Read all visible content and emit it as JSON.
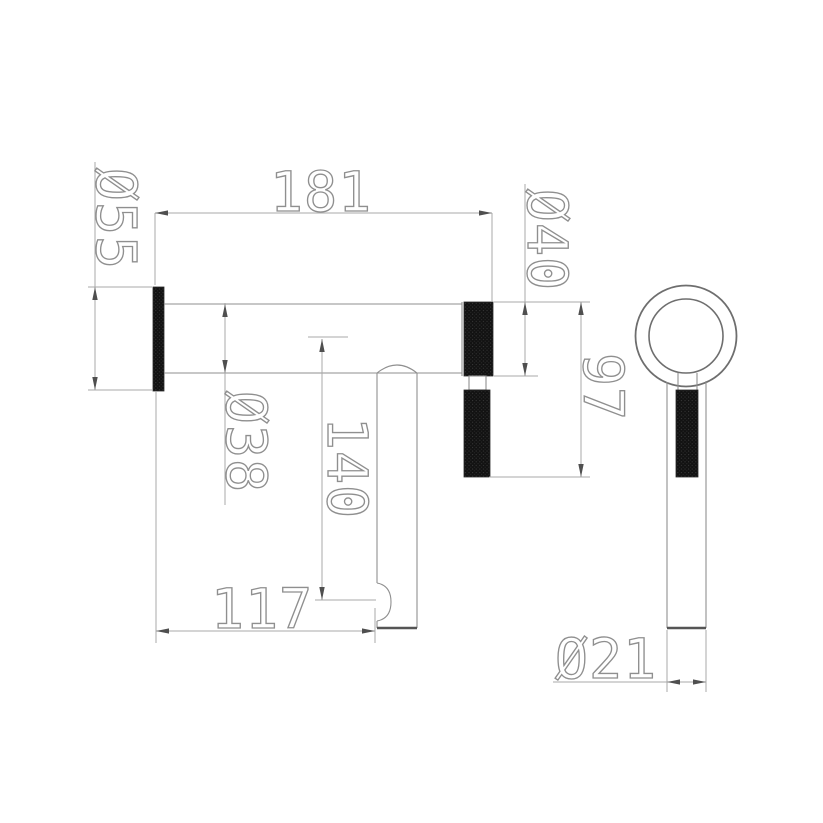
{
  "drawing": {
    "kind": "technical-dimension-drawing",
    "views": {
      "front": {
        "dimensions": {
          "flange_diameter": "Ø55",
          "body_length": "181",
          "end_knurl_diameter": "Ø40",
          "grip_drop_from_axis": "97",
          "body_diameter": "Ø38",
          "spout_drop_from_axis": "140",
          "spout_offset_from_wall": "117"
        }
      },
      "side": {
        "dimensions": {
          "tube_diameter": "Ø21"
        }
      }
    },
    "colors": {
      "background": "#ffffff",
      "outline": "#8f8f8f",
      "dimension_line": "#a8a8a8",
      "arrow": "#4f4f4f",
      "knurl_fill": "#121212",
      "text_stroke": "#8f8f8f"
    }
  }
}
